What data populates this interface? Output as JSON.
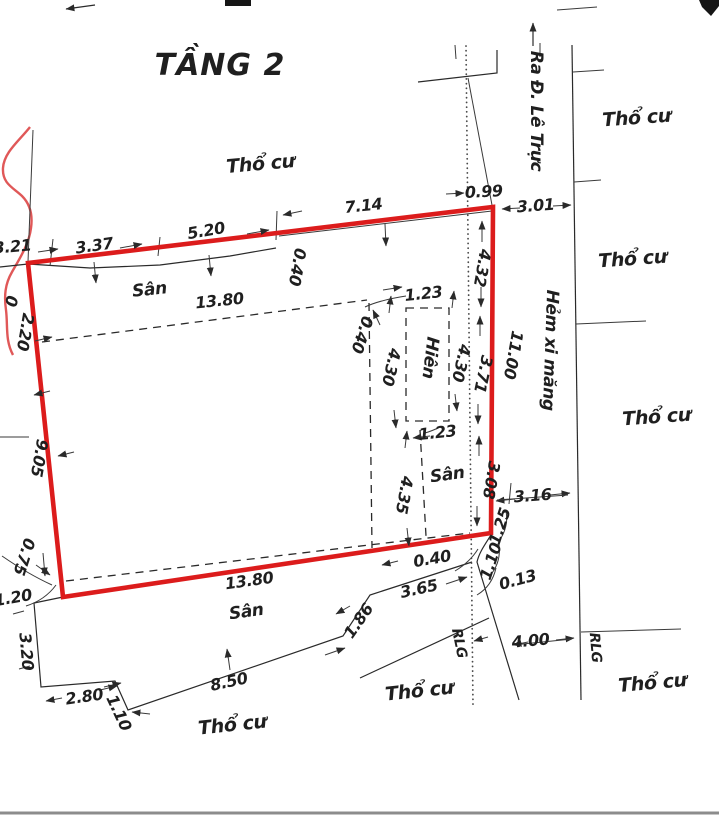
{
  "page": {
    "title": "TẦNG 2"
  },
  "labels": {
    "residential": "Thổ cư",
    "yard": "Sân",
    "porch": "Hiên",
    "alley": "Hẻm xi măng",
    "to_street": "Ra Đ. Lê Trực",
    "road_boundary": "RLG"
  },
  "dimensions": {
    "top_left_edge": "3.21",
    "top_seg_1": "3.37",
    "top_seg_2": "5.20",
    "top_seg_3": "7.14",
    "top_step": "0.40",
    "alley_gap_top": "0.99",
    "alley_width_top": "3.01",
    "right_seg_1": "4.32",
    "right_seg_2": "3.71",
    "right_seg_3": "3.08",
    "right_total": "11.00",
    "left_fragment": "0",
    "left_seg_top": "2.20",
    "left_seg_mid": "9.05",
    "left_seg_low": "0.75",
    "bottom_left_1": "1.20",
    "bottom_left_2": "3.20",
    "bottom_left_3": "2.80",
    "bottom_left_4": "1.10",
    "bottom_seg_long": "8.50",
    "bottom_seg_2": "1.86",
    "bottom_seg_3": "3.65",
    "alley_width_bottom": "4.00",
    "right_gap_bottom": "3.16",
    "corner_seg_1": "1.25",
    "corner_seg_2": "1.10",
    "corner_gap_1": "0.40",
    "corner_gap_2": "0.13",
    "yard_width_top": "13.80",
    "yard_width_bottom": "13.80",
    "porch_width_top": "1.23",
    "porch_width_bottom": "1.23",
    "porch_len_left": "4.30",
    "porch_len_right": "4.30",
    "porch_offset": "0.40",
    "yard_len_right": "4.35"
  },
  "colors": {
    "parcel_outline": "#dc1c1c",
    "sketch_stroke": "#e05858",
    "ink": "#2a2a2a",
    "separator": "#8c8c8c"
  }
}
